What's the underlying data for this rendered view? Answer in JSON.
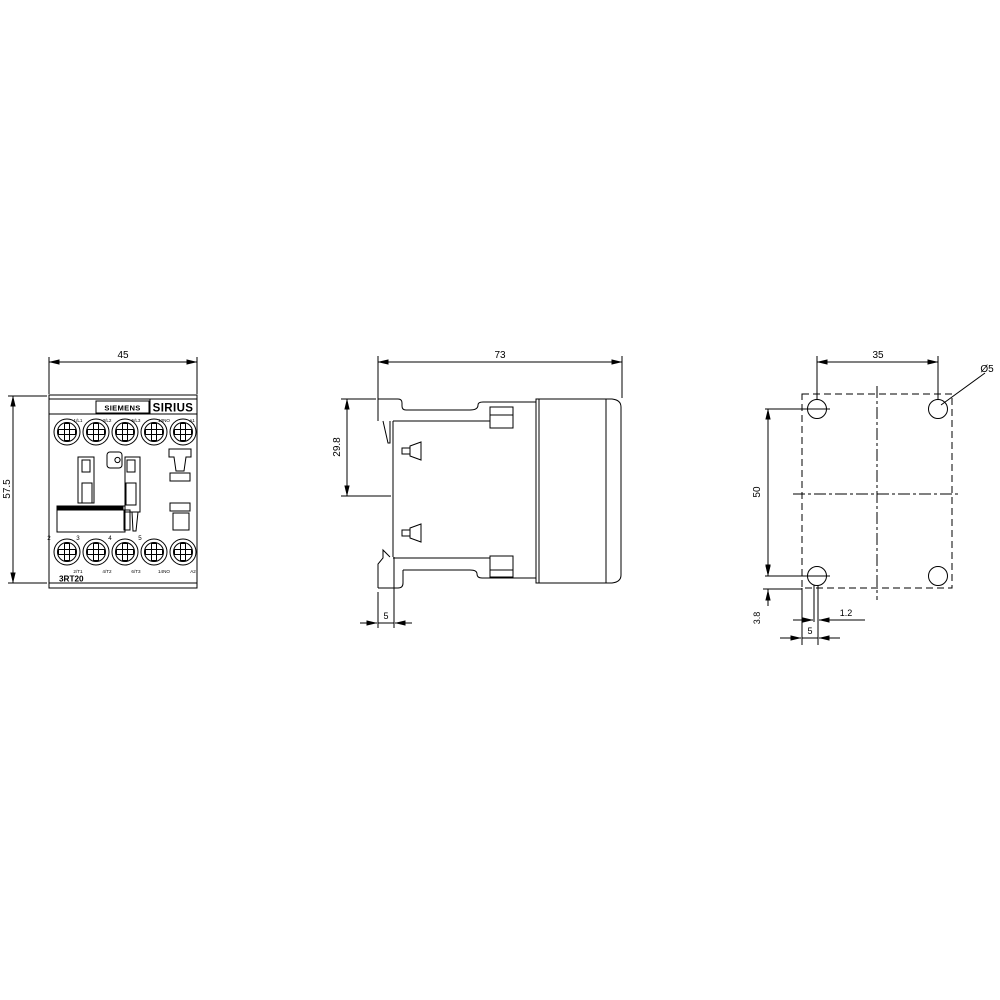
{
  "meta": {
    "description": "Dimensional drawing of Siemens SIRIUS 3RT20 contactor: front view, side view and drilling pattern",
    "line_color": "#000000",
    "background": "#ffffff"
  },
  "front": {
    "brand": "SIEMENS",
    "series": "SIRIUS",
    "model": "3RT20",
    "dim_width": "45",
    "dim_height": "57.5",
    "top_terminals": [
      "1/L1",
      "3/L2",
      "5/L3",
      "13NO",
      "A1"
    ],
    "pole_numbers": [
      "2",
      "3",
      "4",
      "5"
    ],
    "bottom_terminals": [
      "2/T1",
      "4/T2",
      "6/T3",
      "14NO",
      "A2"
    ]
  },
  "side": {
    "dim_depth": "73",
    "dim_rail_offset": "29.8",
    "dim_foot": "5"
  },
  "drill": {
    "dim_spacing_h": "35",
    "dim_spacing_v": "50",
    "dim_bottom_offset": "3.8",
    "dim_gap": "1.2",
    "dim_edge": "5",
    "hole_dia": "Ø5"
  }
}
